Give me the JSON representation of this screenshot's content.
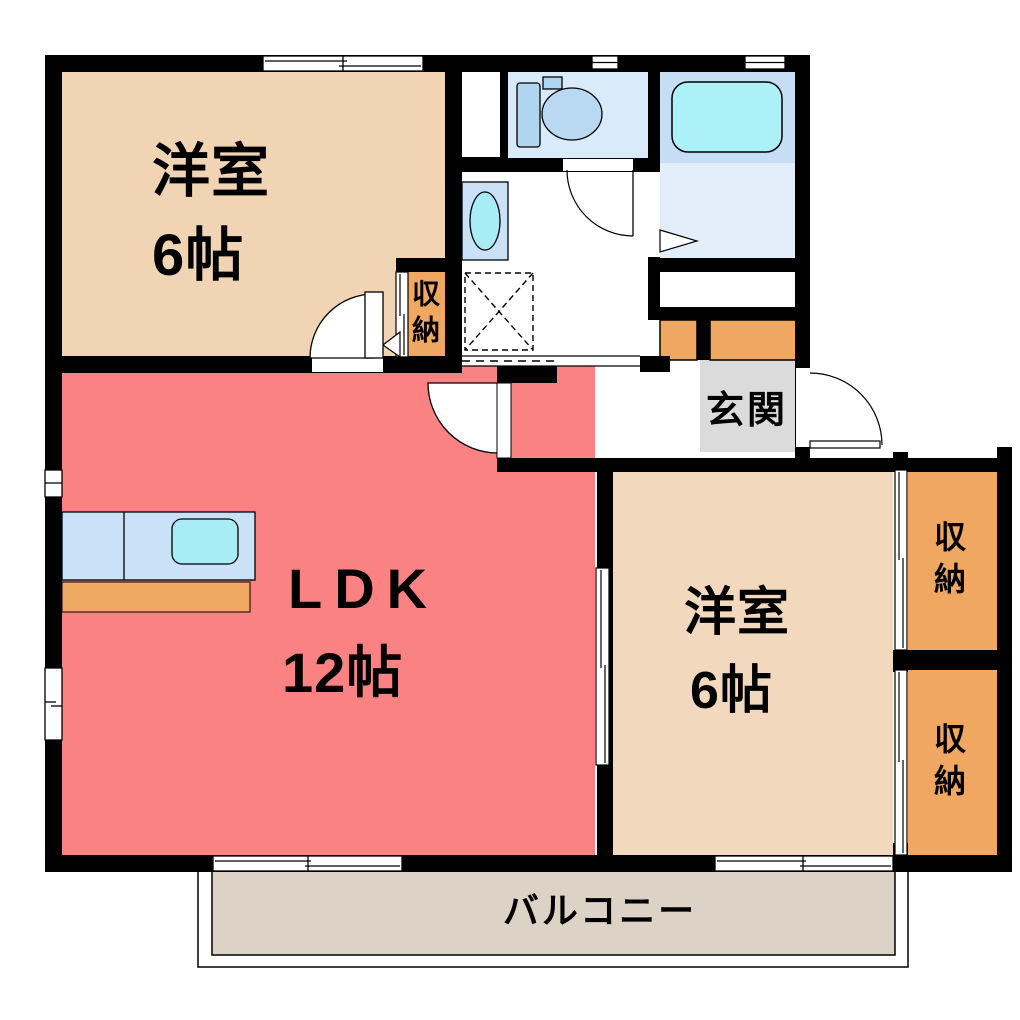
{
  "rooms": {
    "western_room_top": {
      "label": "洋室",
      "size": "6帖"
    },
    "ldk": {
      "label": "LDK",
      "size": "12帖"
    },
    "western_room_bottom": {
      "label": "洋室",
      "size": "6帖"
    },
    "entrance": {
      "label": "玄関"
    },
    "balcony": {
      "label": "バルコニー"
    },
    "closet_hall": {
      "label": "収納"
    },
    "closet_right_upper": {
      "label": "収納"
    },
    "closet_right_lower": {
      "label": "収納"
    }
  },
  "colors": {
    "wall": "#000000",
    "room_beige": "#F1D4B4",
    "room_beige_light": "#F2D8BD",
    "ldk_pink": "#FA8282",
    "closet_orange": "#F0A761",
    "counter_blue": "#C9E2F8",
    "sink_cyan": "#A8EDF6",
    "toilet_floor_blue": "#D9EAFB",
    "bath_floor_blue": "#C5DEF5",
    "bath_floor_light": "#E2EFFA",
    "bathtub_cyan": "#ACF1F8",
    "entrance_gray": "#DBDBDB",
    "balcony_gray": "#DCD3C6"
  }
}
